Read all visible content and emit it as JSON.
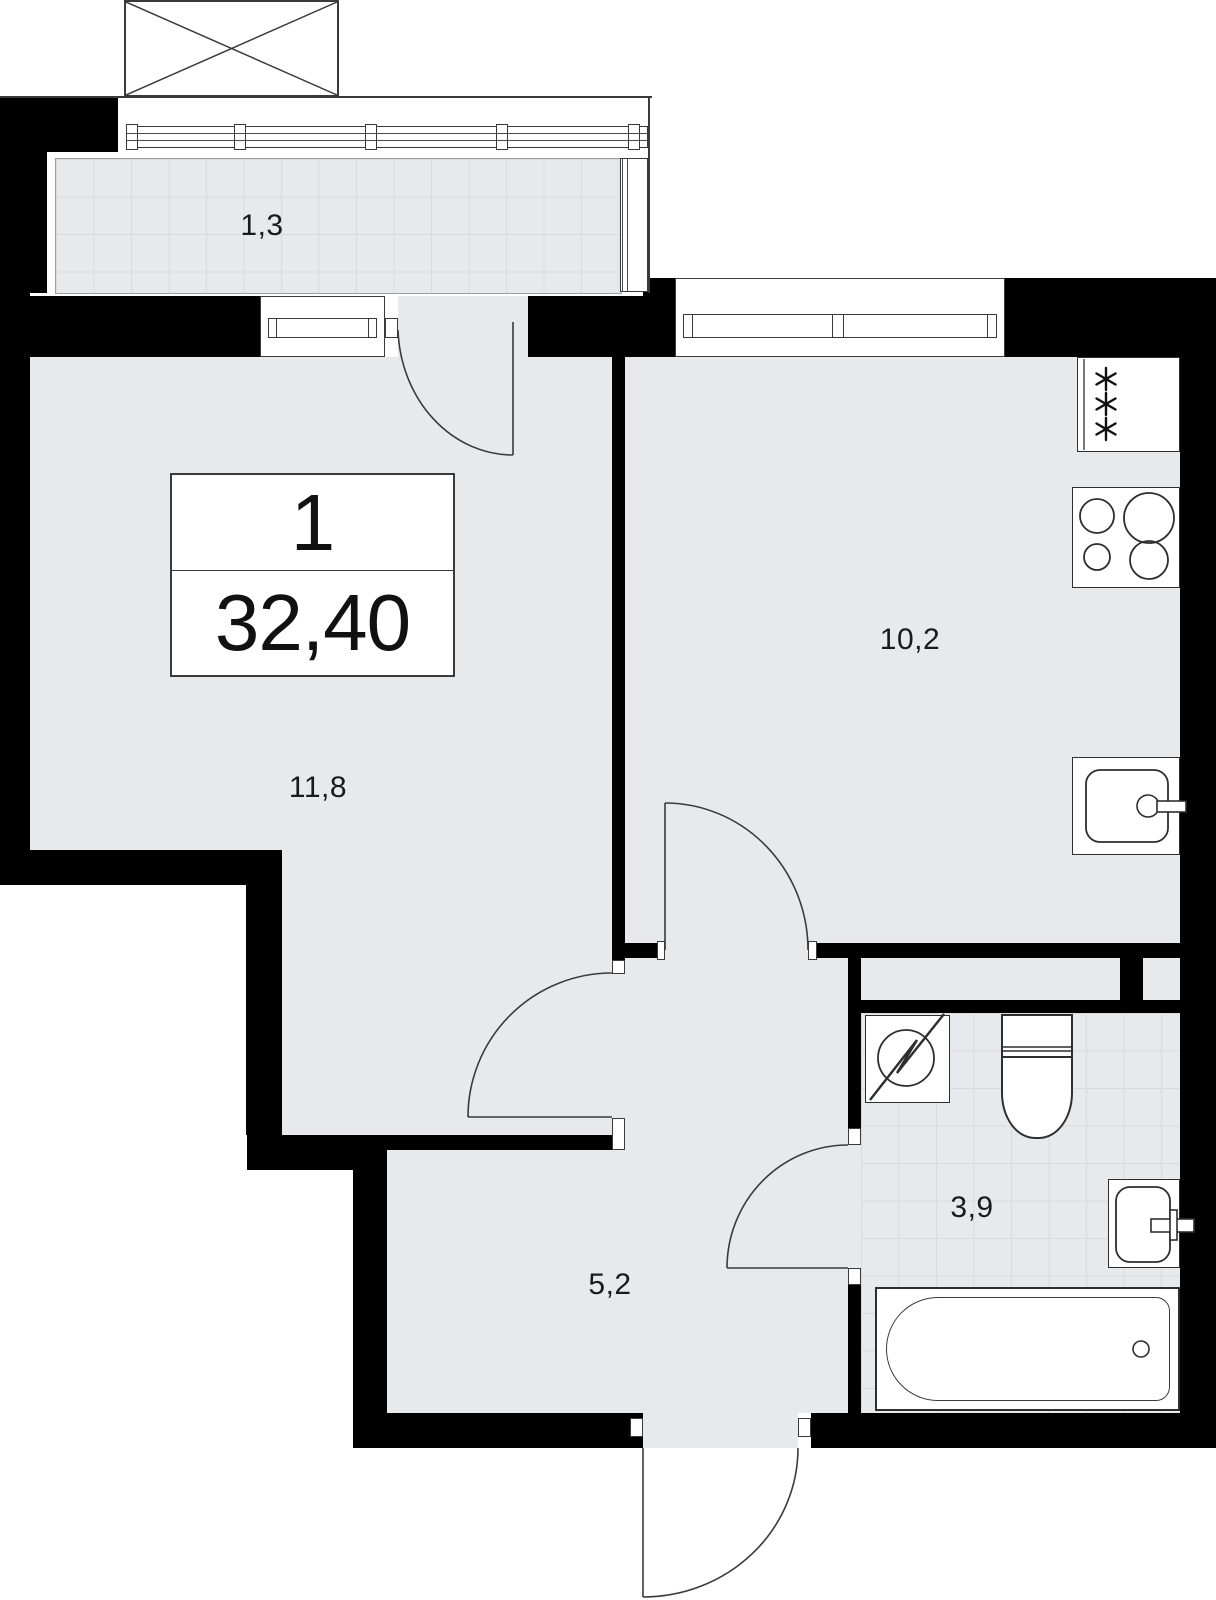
{
  "plan": {
    "type": "apartment-floor-plan",
    "unit": {
      "rooms_count": "1",
      "total_area": "32,40"
    },
    "rooms": [
      {
        "id": "balcony",
        "label": "1,3"
      },
      {
        "id": "kitchen",
        "label": "10,2"
      },
      {
        "id": "living",
        "label": "11,8"
      },
      {
        "id": "hall",
        "label": "5,2"
      },
      {
        "id": "bathroom",
        "label": "3,9"
      }
    ],
    "fixtures": [
      {
        "name": "fridge",
        "icon": "snowflakes-icon"
      },
      {
        "name": "stove",
        "icon": "four-burners-icon"
      },
      {
        "name": "kitchen-sink",
        "icon": "basin-with-tap-icon"
      },
      {
        "name": "washing-machine",
        "icon": "circle-zigzag-icon"
      },
      {
        "name": "toilet",
        "icon": "tank-and-bowl-icon"
      },
      {
        "name": "bathroom-sink",
        "icon": "basin-with-tap-icon"
      },
      {
        "name": "bathtub",
        "icon": "tub-with-drain-icon"
      }
    ],
    "doors": [
      "balcony-door",
      "living-room-door",
      "kitchen-door",
      "bathroom-door",
      "entrance-door"
    ],
    "colors": {
      "wall": "#000000",
      "floor": "#e7eaed",
      "tile_line": "#d8dbde",
      "stroke": "#2e2e2e",
      "line": "#3a3a3a",
      "text": "#1a1a1a",
      "bg": "#ffffff"
    }
  }
}
